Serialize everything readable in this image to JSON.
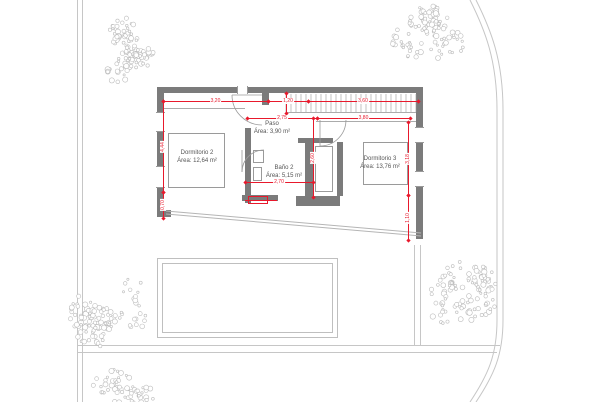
{
  "drawing": {
    "title": "floor-plan",
    "rooms": [
      {
        "name": "Dormitorio 2",
        "area": "Área: 12,64 m²"
      },
      {
        "name": "Paso",
        "area": "Área: 3,90 m²"
      },
      {
        "name": "Baño 2",
        "area": "Área: 5,15 m²"
      },
      {
        "name": "Dormitorio 3",
        "area": "Área: 13,76 m²"
      }
    ],
    "dimensions": {
      "top": [
        "3,20",
        "1,20",
        "3,60"
      ],
      "upper_mid": [
        "2,75",
        "3,80"
      ],
      "inner": [
        "2,70"
      ],
      "left": [
        "4,44",
        "0,70"
      ],
      "right": [
        "3,18",
        "1,10"
      ],
      "center_vertical": [
        "2,60"
      ]
    },
    "colors": {
      "dimension_red": "#e8192c",
      "wall_gray": "#7b7b7b",
      "line_gray": "#9a9a9a",
      "site_gray": "#c6c6c6",
      "text_gray": "#555555"
    }
  },
  "site": {
    "trees": [
      {
        "cx": 122,
        "cy": 46,
        "r": 38
      },
      {
        "cx": 427,
        "cy": 38,
        "r": 40
      },
      {
        "cx": 110,
        "cy": 312,
        "r": 44
      },
      {
        "cx": 128,
        "cy": 392,
        "r": 36
      },
      {
        "cx": 462,
        "cy": 298,
        "r": 42
      }
    ]
  }
}
